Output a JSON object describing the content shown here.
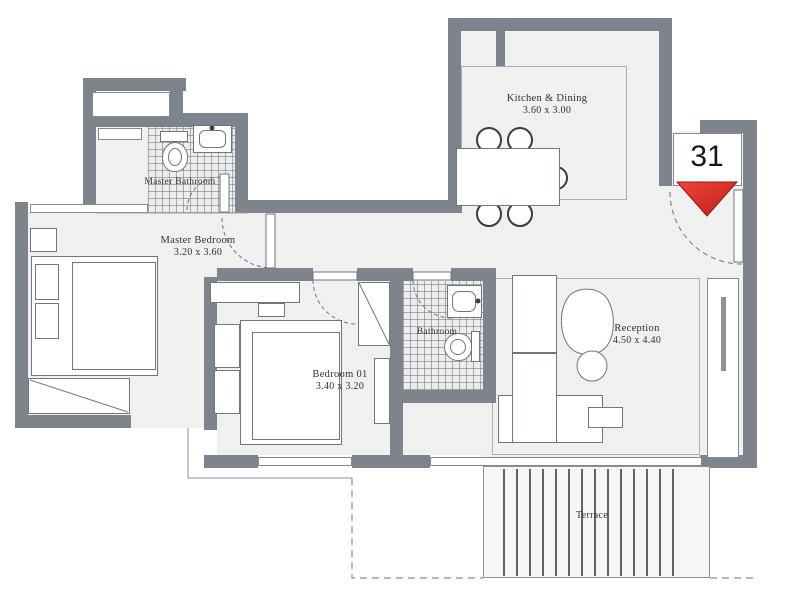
{
  "unit": {
    "number": "31"
  },
  "rooms": {
    "kitchen": {
      "name": "Kitchen & Dining",
      "dims": "3.60 x 3.00"
    },
    "master_bathroom": {
      "name": "Master Bathroom"
    },
    "master_bedroom": {
      "name": "Master Bedroom",
      "dims": "3.20 x 3.60"
    },
    "bedroom01": {
      "name": "Bedroom 01",
      "dims": "3.40 x 3.20"
    },
    "bathroom": {
      "name": "Bathroom"
    },
    "reception": {
      "name": "Reception",
      "dims": "4.50 x 4.40"
    },
    "terrace": {
      "name": "Terrace"
    }
  },
  "icons": {
    "entrance_arrow": "▼ red chevron marking unit entrance"
  },
  "colors": {
    "wall": "#7d848c",
    "floor": "#f0f0ee",
    "tile_line": "#6c747c",
    "entrance_red": "#d92a24",
    "text": "#2e3237",
    "background": "#ffffff"
  }
}
